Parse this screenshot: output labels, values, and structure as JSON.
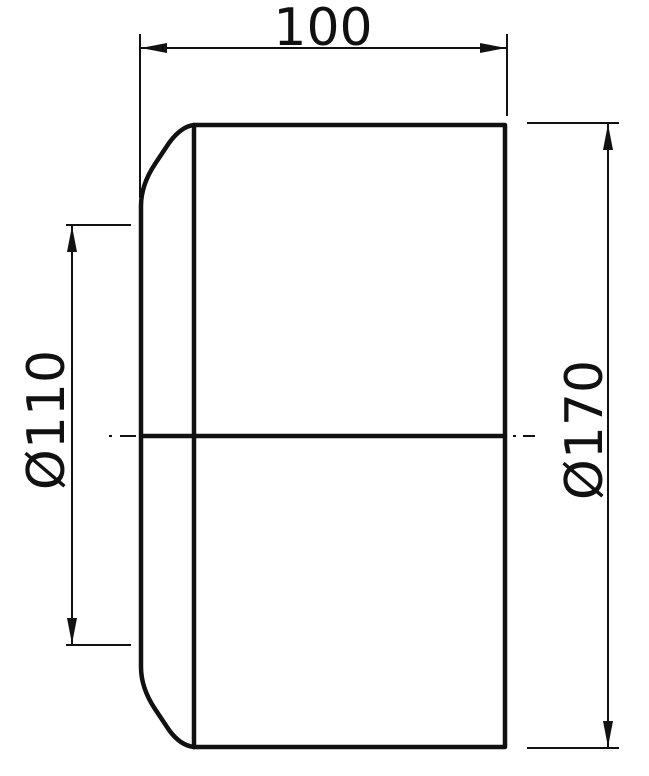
{
  "drawing": {
    "kind": "technical-dimension-drawing",
    "view": "side view of cylindrical part with chamfered nose",
    "labels": {
      "length": "100",
      "inner_diameter": "Ø110",
      "outer_diameter": "Ø170"
    },
    "colors": {
      "line": "#111111",
      "background": "#ffffff"
    }
  }
}
